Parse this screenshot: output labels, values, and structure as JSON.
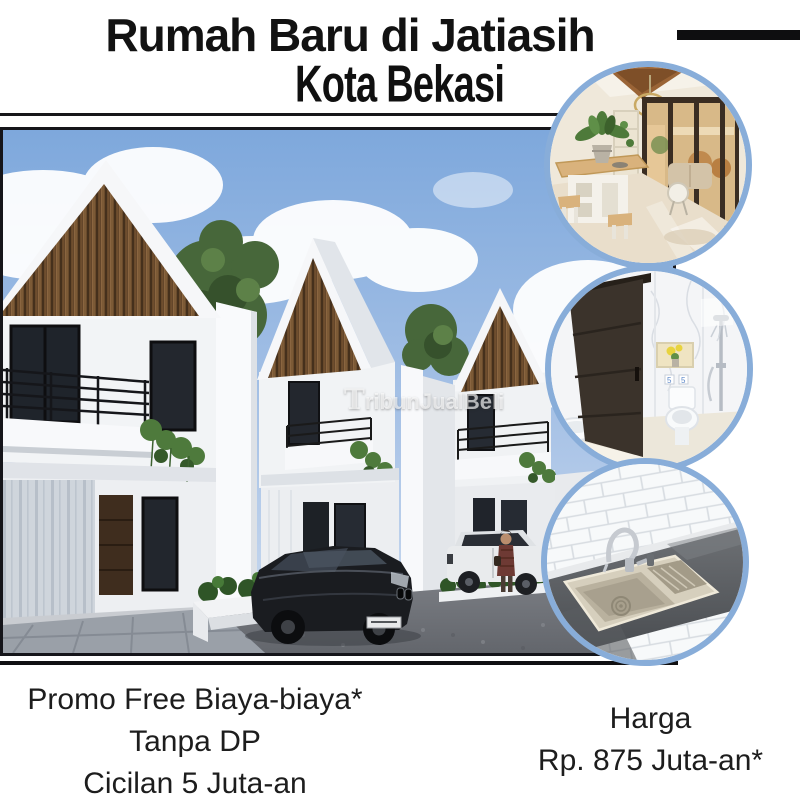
{
  "header": {
    "title": "Rumah Baru di Jatiasih",
    "subtitle": "Kota Bekasi"
  },
  "photo": {
    "watermark": "TribunJualBeli"
  },
  "media": {
    "main_photo": "new-townhouse-3d-render",
    "inset_photos": [
      "dining-room",
      "bathroom",
      "kitchen-sink"
    ]
  },
  "promo": {
    "line1": "Promo Free Biaya-biaya*",
    "line2": "Tanpa DP",
    "line3": "Cicilan 5 Juta-an"
  },
  "price": {
    "label": "Harga",
    "value": "Rp. 875 Juta-an*"
  },
  "colors": {
    "accent_blue": "#88add9",
    "text": "#1d1d1d",
    "rule_black": "#101012"
  }
}
